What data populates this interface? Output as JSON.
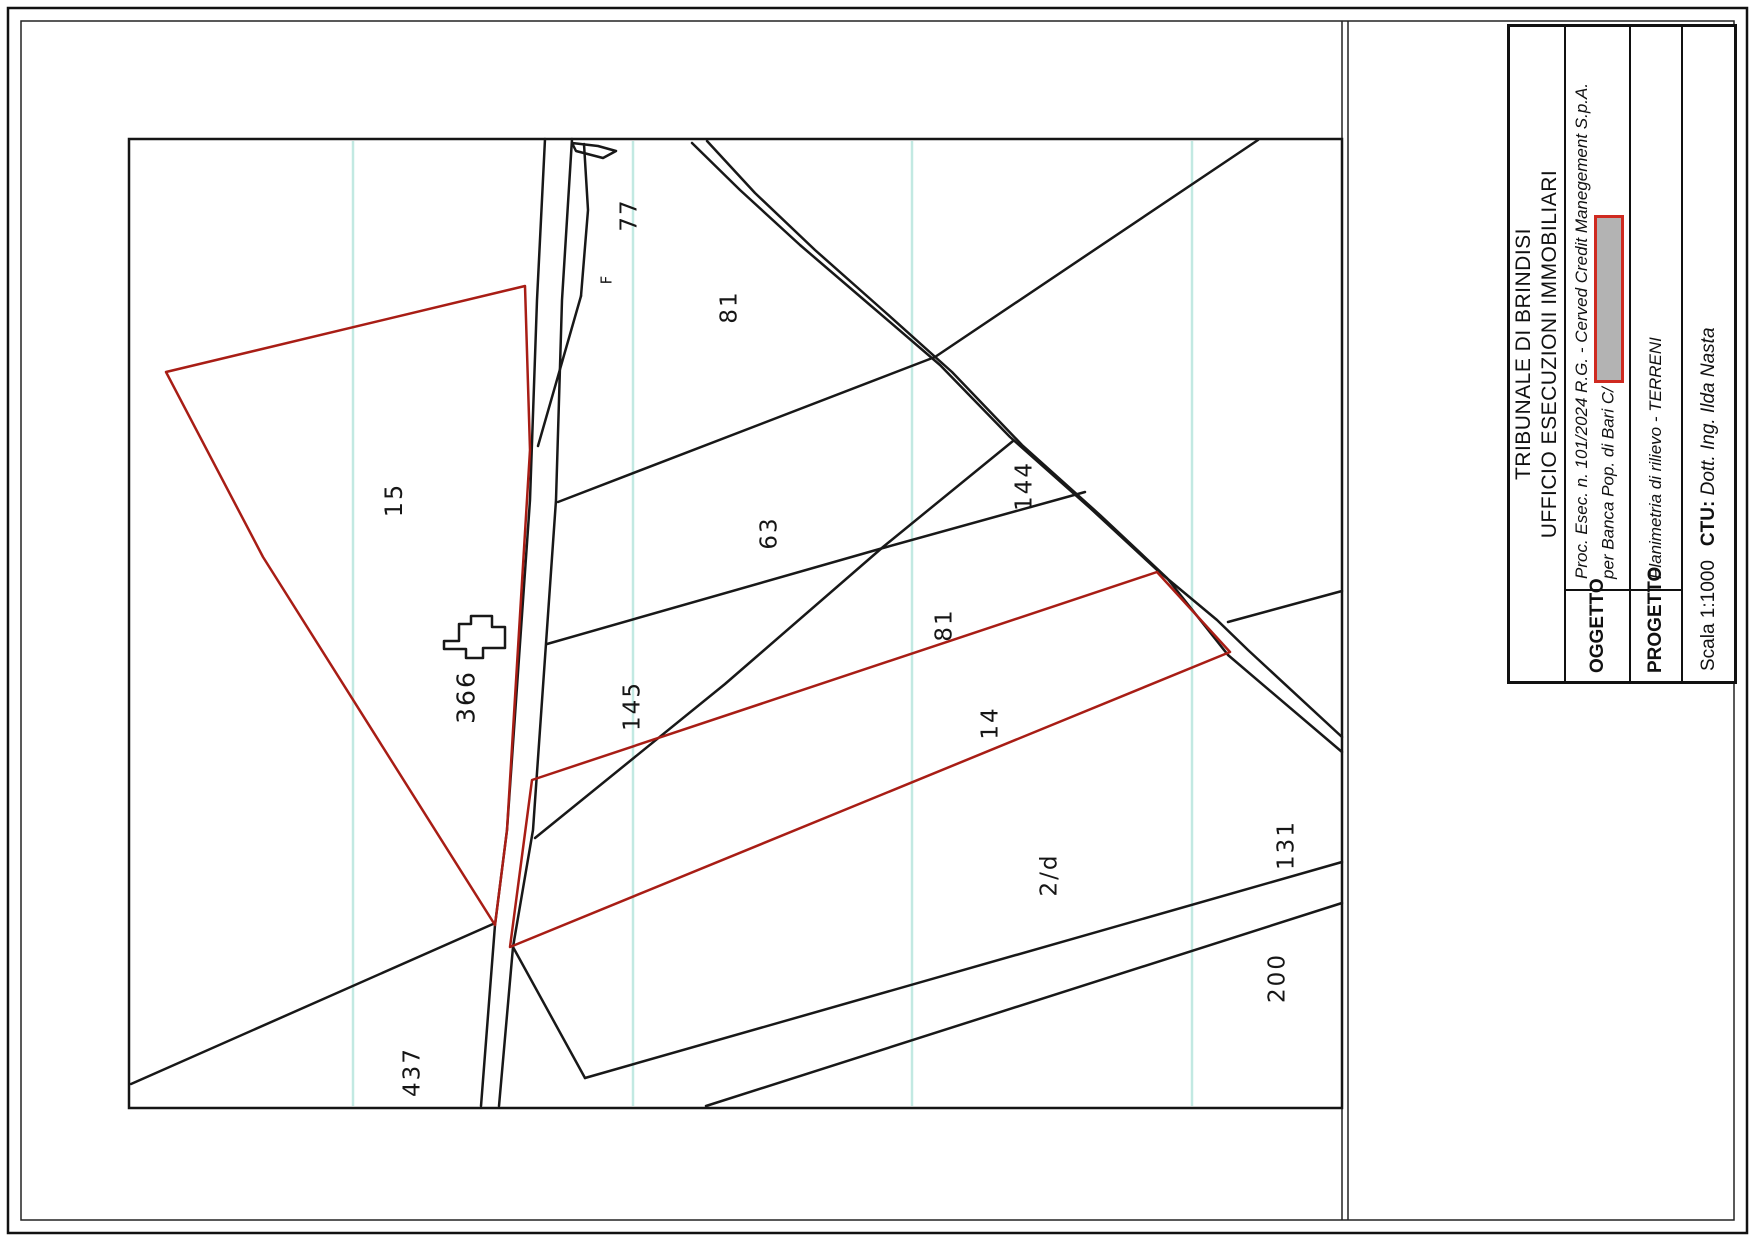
{
  "title_block": {
    "court_line1": "TRIBUNALE DI BRINDISI",
    "court_line2": "UFFICIO ESECUZIONI IMMOBILIARI",
    "oggetto_label": "OGGETTO",
    "oggetto_line1": "Proc. Esec. n. 101/2024 R.G. -  Cerved Credit Manegement S.p.A.",
    "oggetto_line2": "per Banca Pop. di Bari C/",
    "progetto_label": "PROGETTO",
    "progetto_value": "Planimetria di rilievo - TERRENI",
    "scala_value": "Scala 1:1000",
    "ctu_label": "CTU:",
    "ctu_value": "Dott. Ing. Ilda Nasta"
  },
  "map": {
    "colors": {
      "boundary": "#181818",
      "highlight": "#a81d15",
      "grid_line": "#c2e9e2",
      "redaction_fill": "#b3b3b3",
      "redaction_border": "#cf2a20"
    },
    "parcels": [
      {
        "id": "15",
        "x": 394,
        "y": 500,
        "size": 24
      },
      {
        "id": "366",
        "x": 466,
        "y": 697,
        "size": 25
      },
      {
        "id": "77",
        "x": 630,
        "y": 215,
        "size": 23
      },
      {
        "id": "F",
        "x": 607,
        "y": 279,
        "size": 15
      },
      {
        "id": "81",
        "x": 730,
        "y": 307,
        "size": 23
      },
      {
        "id": "63",
        "x": 770,
        "y": 533,
        "size": 23
      },
      {
        "id": "144",
        "x": 1025,
        "y": 486,
        "size": 23
      },
      {
        "id": "145",
        "x": 633,
        "y": 706,
        "size": 23
      },
      {
        "id": "81",
        "x": 945,
        "y": 625,
        "size": 23
      },
      {
        "id": "14",
        "x": 991,
        "y": 723,
        "size": 23
      },
      {
        "id": "2/d",
        "x": 1050,
        "y": 875,
        "size": 23
      },
      {
        "id": "437",
        "x": 413,
        "y": 1072,
        "size": 23
      },
      {
        "id": "131",
        "x": 1287,
        "y": 845,
        "size": 23
      },
      {
        "id": "200",
        "x": 1278,
        "y": 978,
        "size": 23
      }
    ]
  }
}
